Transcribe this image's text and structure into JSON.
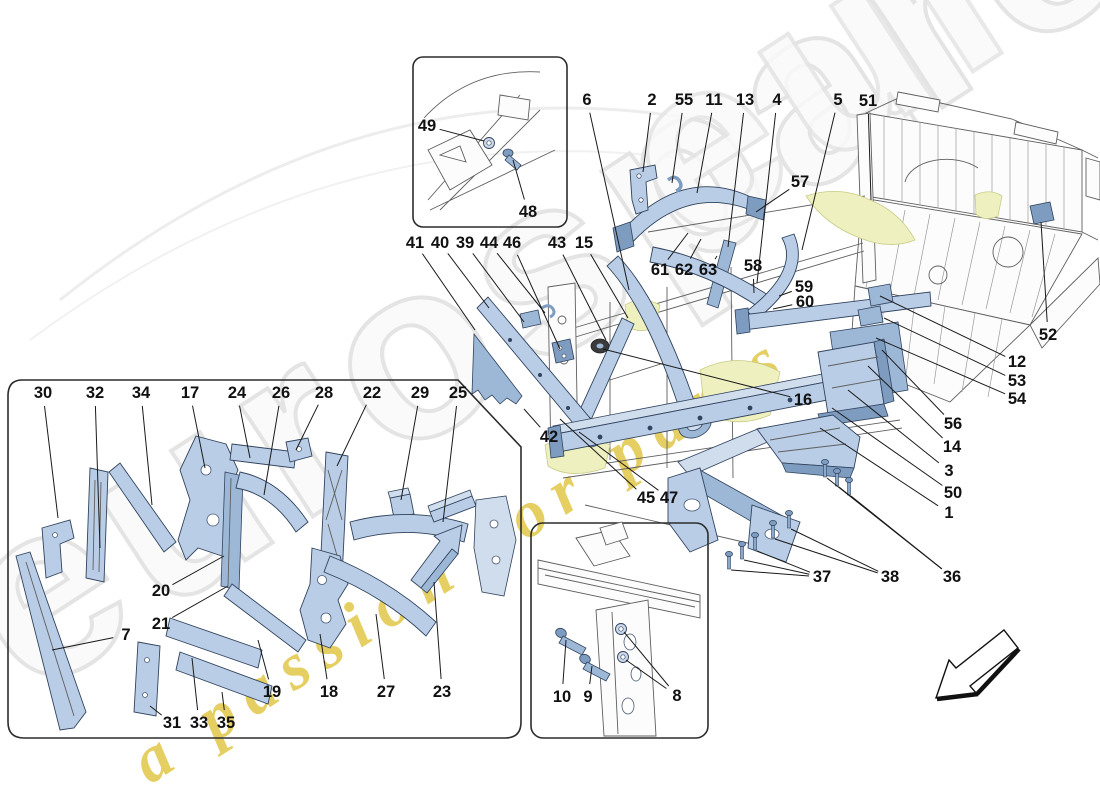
{
  "watermark": {
    "brand_text": "eurospares",
    "tagline_text": "a passion for parts",
    "brand_color": "#e4e4e4",
    "tagline_color": "#e0c43c"
  },
  "palette": {
    "part_blue": "#b9cde6",
    "part_blue_light": "#cfdded",
    "part_blue_mid": "#9db8d6",
    "part_blue_dark": "#7d9cc0",
    "outline_dark": "#31435e",
    "chassis_line": "#5f5f5f",
    "highlight_yellow": "#eef0c0",
    "highlight_yellow_edge": "#c9cc86",
    "leader_black": "#1a1a1a",
    "watermark_gray": "#e4e4e4",
    "watermark_yellow": "#e0c43c"
  },
  "callouts": [
    {
      "label": "6",
      "x": 587,
      "y": 100,
      "targets": [
        [
          629,
          290
        ]
      ]
    },
    {
      "label": "2",
      "x": 652,
      "y": 100,
      "targets": [
        [
          643,
          172
        ]
      ]
    },
    {
      "label": "55",
      "x": 684,
      "y": 100,
      "targets": [
        [
          672,
          183
        ]
      ]
    },
    {
      "label": "11",
      "x": 714,
      "y": 100,
      "targets": [
        [
          697,
          193
        ]
      ]
    },
    {
      "label": "13",
      "x": 745,
      "y": 100,
      "targets": [
        [
          728,
          247
        ]
      ]
    },
    {
      "label": "4",
      "x": 777,
      "y": 100,
      "targets": [
        [
          757,
          283
        ]
      ]
    },
    {
      "label": "5",
      "x": 838,
      "y": 100,
      "targets": [
        [
          802,
          250
        ]
      ]
    },
    {
      "label": "51",
      "x": 868,
      "y": 101,
      "targets": [
        [
          871,
          200
        ]
      ]
    },
    {
      "label": "57",
      "x": 800,
      "y": 182,
      "targets": [
        [
          756,
          212
        ]
      ]
    },
    {
      "label": "41",
      "x": 415,
      "y": 243,
      "targets": [
        [
          475,
          330
        ]
      ]
    },
    {
      "label": "40",
      "x": 440,
      "y": 243,
      "targets": [
        [
          489,
          308
        ]
      ]
    },
    {
      "label": "39",
      "x": 465,
      "y": 243,
      "targets": [
        [
          524,
          322
        ]
      ]
    },
    {
      "label": "44",
      "x": 489,
      "y": 243,
      "targets": [
        [
          545,
          313
        ]
      ]
    },
    {
      "label": "46",
      "x": 512,
      "y": 243,
      "targets": [
        [
          560,
          349
        ]
      ]
    },
    {
      "label": "43",
      "x": 557,
      "y": 243,
      "targets": [
        [
          606,
          340
        ]
      ]
    },
    {
      "label": "15",
      "x": 584,
      "y": 243,
      "targets": [
        [
          628,
          318
        ]
      ]
    },
    {
      "label": "61",
      "x": 660,
      "y": 270,
      "targets": [
        [
          688,
          233
        ]
      ]
    },
    {
      "label": "62",
      "x": 684,
      "y": 270,
      "targets": [
        [
          701,
          239
        ]
      ]
    },
    {
      "label": "63",
      "x": 708,
      "y": 270,
      "targets": [
        [
          717,
          256
        ]
      ]
    },
    {
      "label": "58",
      "x": 753,
      "y": 266,
      "targets": [
        [
          754,
          293
        ]
      ]
    },
    {
      "label": "59",
      "x": 804,
      "y": 287,
      "targets": [
        [
          779,
          296
        ]
      ]
    },
    {
      "label": "60",
      "x": 805,
      "y": 302,
      "targets": [
        [
          773,
          309
        ]
      ]
    },
    {
      "label": "52",
      "x": 1048,
      "y": 335,
      "targets": [
        [
          1041,
          222
        ]
      ]
    },
    {
      "label": "12",
      "x": 1017,
      "y": 362,
      "targets": [
        [
          880,
          296
        ]
      ]
    },
    {
      "label": "53",
      "x": 1017,
      "y": 381,
      "targets": [
        [
          884,
          318
        ]
      ]
    },
    {
      "label": "54",
      "x": 1017,
      "y": 399,
      "targets": [
        [
          876,
          338
        ]
      ]
    },
    {
      "label": "56",
      "x": 953,
      "y": 424,
      "targets": [
        [
          882,
          350
        ]
      ]
    },
    {
      "label": "14",
      "x": 952,
      "y": 447,
      "targets": [
        [
          868,
          366
        ]
      ]
    },
    {
      "label": "3",
      "x": 949,
      "y": 471,
      "targets": [
        [
          848,
          390
        ]
      ]
    },
    {
      "label": "50",
      "x": 953,
      "y": 493,
      "targets": [
        [
          832,
          408
        ]
      ]
    },
    {
      "label": "1",
      "x": 949,
      "y": 513,
      "targets": [
        [
          820,
          428
        ]
      ]
    },
    {
      "label": "16",
      "x": 803,
      "y": 400,
      "targets": [
        [
          603,
          349
        ]
      ]
    },
    {
      "label": "42",
      "x": 549,
      "y": 437,
      "targets": [
        [
          524,
          409
        ]
      ]
    },
    {
      "label": "45",
      "x": 646,
      "y": 498,
      "targets": [
        [
          560,
          419
        ]
      ]
    },
    {
      "label": "47",
      "x": 669,
      "y": 498,
      "targets": [
        [
          579,
          432
        ]
      ]
    },
    {
      "label": "37",
      "x": 822,
      "y": 577,
      "targets": [
        [
          731,
          570
        ],
        [
          744,
          560
        ],
        [
          757,
          551
        ]
      ]
    },
    {
      "label": "38",
      "x": 890,
      "y": 577,
      "targets": [
        [
          775,
          539
        ],
        [
          791,
          529
        ]
      ]
    },
    {
      "label": "36",
      "x": 952,
      "y": 577,
      "targets": [
        [
          827,
          478
        ],
        [
          839,
          487
        ],
        [
          851,
          496
        ]
      ]
    },
    {
      "label": "49",
      "x": 427,
      "y": 126,
      "targets": [
        [
          484,
          141
        ]
      ]
    },
    {
      "label": "48",
      "x": 528,
      "y": 212,
      "targets": [
        [
          513,
          160
        ]
      ]
    },
    {
      "label": "30",
      "x": 43,
      "y": 393,
      "targets": [
        [
          58,
          518
        ]
      ]
    },
    {
      "label": "32",
      "x": 95,
      "y": 393,
      "targets": [
        [
          100,
          548
        ]
      ]
    },
    {
      "label": "34",
      "x": 141,
      "y": 393,
      "targets": [
        [
          152,
          505
        ]
      ]
    },
    {
      "label": "17",
      "x": 190,
      "y": 393,
      "targets": [
        [
          205,
          468
        ]
      ]
    },
    {
      "label": "24",
      "x": 237,
      "y": 393,
      "targets": [
        [
          250,
          458
        ]
      ]
    },
    {
      "label": "26",
      "x": 281,
      "y": 393,
      "targets": [
        [
          264,
          495
        ]
      ]
    },
    {
      "label": "28",
      "x": 324,
      "y": 393,
      "targets": [
        [
          296,
          450
        ]
      ]
    },
    {
      "label": "22",
      "x": 372,
      "y": 393,
      "targets": [
        [
          337,
          466
        ]
      ]
    },
    {
      "label": "29",
      "x": 420,
      "y": 393,
      "targets": [
        [
          401,
          500
        ]
      ]
    },
    {
      "label": "25",
      "x": 458,
      "y": 393,
      "targets": [
        [
          443,
          522
        ]
      ]
    },
    {
      "label": "20",
      "x": 161,
      "y": 591,
      "targets": [
        [
          224,
          556
        ]
      ]
    },
    {
      "label": "21",
      "x": 161,
      "y": 624,
      "targets": [
        [
          228,
          586
        ]
      ]
    },
    {
      "label": "7",
      "x": 126,
      "y": 635,
      "targets": [
        [
          52,
          650
        ]
      ]
    },
    {
      "label": "19",
      "x": 272,
      "y": 692,
      "targets": [
        [
          258,
          640
        ]
      ]
    },
    {
      "label": "18",
      "x": 329,
      "y": 692,
      "targets": [
        [
          320,
          634
        ]
      ]
    },
    {
      "label": "27",
      "x": 386,
      "y": 692,
      "targets": [
        [
          376,
          614
        ]
      ]
    },
    {
      "label": "23",
      "x": 442,
      "y": 692,
      "targets": [
        [
          434,
          582
        ]
      ]
    },
    {
      "label": "31",
      "x": 172,
      "y": 723,
      "targets": [
        [
          150,
          706
        ]
      ]
    },
    {
      "label": "33",
      "x": 199,
      "y": 723,
      "targets": [
        [
          192,
          658
        ]
      ]
    },
    {
      "label": "35",
      "x": 226,
      "y": 723,
      "targets": [
        [
          222,
          692
        ]
      ]
    },
    {
      "label": "10",
      "x": 562,
      "y": 697,
      "targets": [
        [
          566,
          640
        ]
      ]
    },
    {
      "label": "9",
      "x": 588,
      "y": 697,
      "targets": [
        [
          592,
          666
        ]
      ]
    },
    {
      "label": "8",
      "x": 677,
      "y": 696,
      "targets": [
        [
          624,
          632
        ],
        [
          626,
          660
        ]
      ]
    }
  ]
}
